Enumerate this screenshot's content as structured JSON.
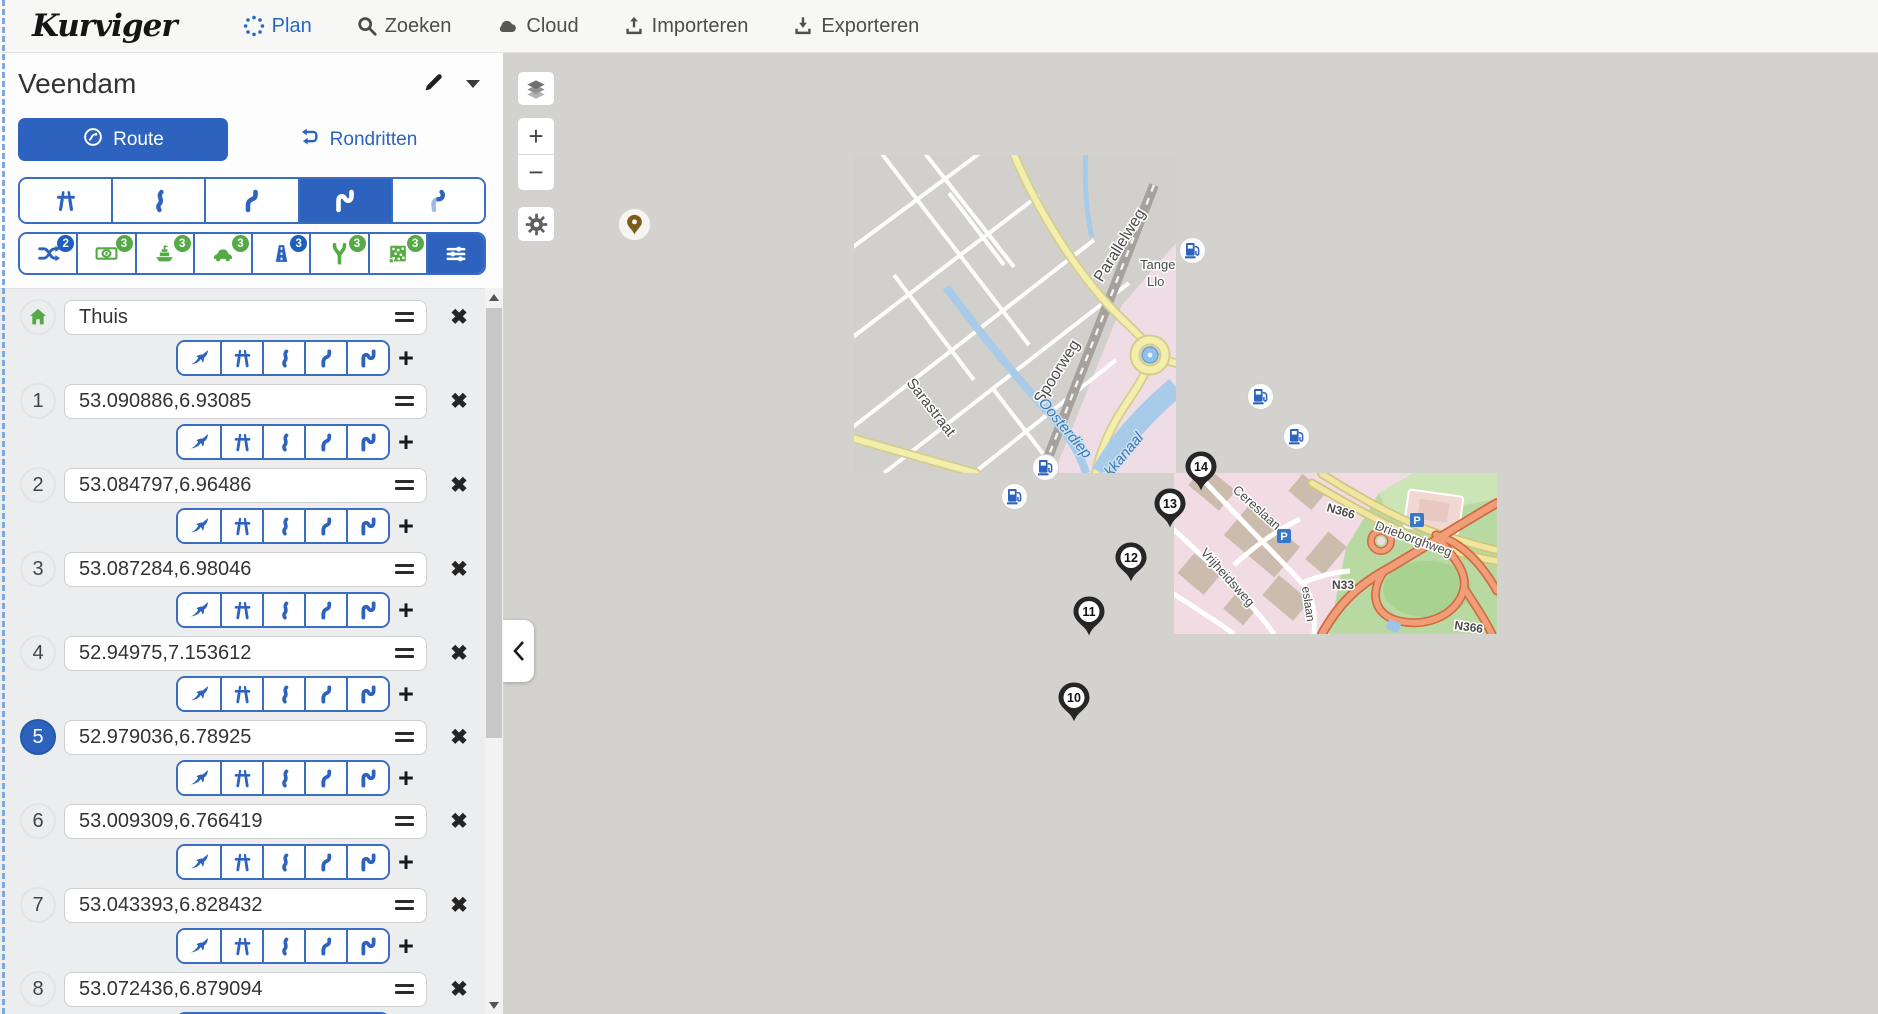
{
  "navbar": {
    "logo": "Kurviger",
    "items": [
      {
        "label": "Plan",
        "active": true
      },
      {
        "label": "Zoeken",
        "active": false
      },
      {
        "label": "Cloud",
        "active": false
      },
      {
        "label": "Importeren",
        "active": false
      },
      {
        "label": "Exporteren",
        "active": false
      }
    ]
  },
  "sidebar": {
    "title": "Veendam",
    "tabs": {
      "route": "Route",
      "roundtrips": "Rondritten"
    },
    "route_profiles": {
      "options": [
        "fastest",
        "curvy-light",
        "curvy",
        "very-curvy",
        "extra-curvy"
      ],
      "active": "very-curvy"
    },
    "route_options": [
      {
        "name": "shuffle",
        "badge": "2",
        "color": "blue"
      },
      {
        "name": "toll",
        "badge": "3",
        "color": "green"
      },
      {
        "name": "ferry",
        "badge": "3",
        "color": "green"
      },
      {
        "name": "car-roads",
        "badge": "3",
        "color": "green"
      },
      {
        "name": "motorway",
        "badge": "3",
        "color": "blue"
      },
      {
        "name": "unpaved",
        "badge": "3",
        "color": "green"
      },
      {
        "name": "cobblestone",
        "badge": "3",
        "color": "green"
      },
      {
        "name": "settings",
        "badge": "",
        "color": "active"
      }
    ],
    "waypoints": [
      {
        "marker": "home",
        "value": "Thuis",
        "active": false
      },
      {
        "marker": "1",
        "value": "53.090886,6.93085",
        "active": false
      },
      {
        "marker": "2",
        "value": "53.084797,6.96486",
        "active": false
      },
      {
        "marker": "3",
        "value": "53.087284,6.98046",
        "active": false
      },
      {
        "marker": "4",
        "value": "52.94975,7.153612",
        "active": false
      },
      {
        "marker": "5",
        "value": "52.979036,6.78925",
        "active": true
      },
      {
        "marker": "6",
        "value": "53.009309,6.766419",
        "active": false
      },
      {
        "marker": "7",
        "value": "53.043393,6.828432",
        "active": false
      },
      {
        "marker": "8",
        "value": "53.072436,6.879094",
        "active": false
      }
    ]
  },
  "map": {
    "controls": {
      "zoom_in": "+",
      "zoom_out": "−"
    },
    "pins": [
      {
        "label": "10",
        "x": 571,
        "y": 645
      },
      {
        "label": "11",
        "x": 586,
        "y": 559
      },
      {
        "label": "12",
        "x": 628,
        "y": 505
      },
      {
        "label": "13",
        "x": 667,
        "y": 451
      },
      {
        "label": "14",
        "x": 698,
        "y": 414
      }
    ],
    "fuel_stations": [
      {
        "x": 689,
        "y": 197
      },
      {
        "x": 757,
        "y": 343
      },
      {
        "x": 793,
        "y": 383
      },
      {
        "x": 542,
        "y": 414
      },
      {
        "x": 511,
        "y": 443
      }
    ],
    "poi_marker": {
      "x": 131,
      "y": 171
    },
    "labels": {
      "sarastraat": "Sarastraat",
      "spoorweg": "Spoorweg",
      "parallelweg": "Parallelweg",
      "oosterdiep": "Oosterdiep",
      "kanaal": "ckkanaal",
      "tange": "Tange",
      "llo": "Llo",
      "cereslaan": "Cereslaan",
      "vrijheidsweg": "Vrijheidsweg",
      "drieborghweg": "Drieborghweg",
      "n366_a": "N366",
      "n366_b": "N366",
      "n33": "N33",
      "eslaan": "eslaan",
      "parking": "P"
    }
  }
}
